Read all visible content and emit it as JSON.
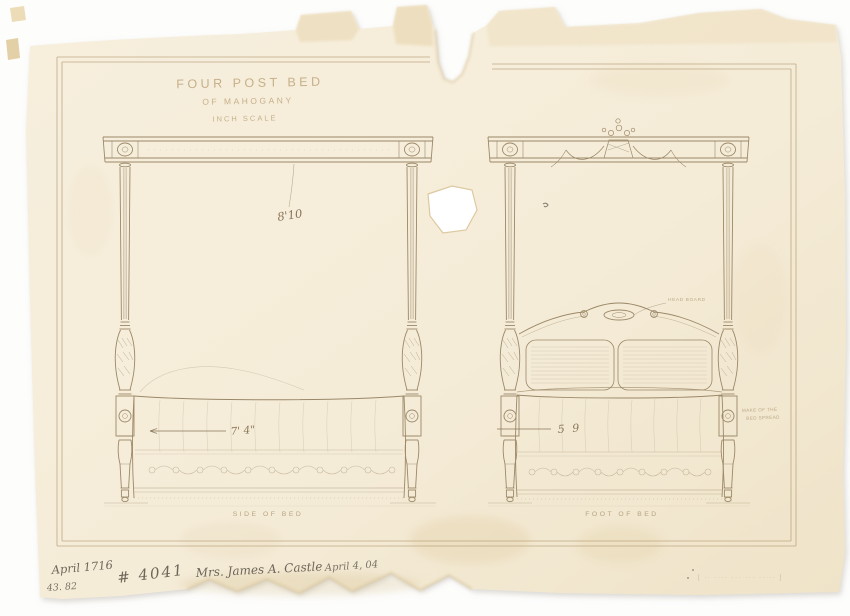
{
  "sheet": {
    "title": {
      "line1": "FOUR POST BED",
      "line2": "OF MAHOGANY",
      "line3": "INCH SCALE"
    },
    "colors": {
      "paper": "#f5ecd8",
      "ink": "#9b8868",
      "graphite": "#6f665a"
    },
    "side_view": {
      "caption": "SIDE OF BED",
      "height_dim": "8'10",
      "length_dim": "7' 4\""
    },
    "foot_view": {
      "caption": "FOOT OF BED",
      "width_dim": "5 9",
      "headboard_label": "HEAD BOARD",
      "spread_note_line1": "MAKE OF THE",
      "spread_note_line2": "BED SPREAD"
    },
    "inscriptions": {
      "date_left_line1": "April 1716",
      "date_left_line2": "43. 82",
      "order_number": "# 4041",
      "client": "Mrs. James A. Castle",
      "date_right": "April 4, 04",
      "faint_stamp": "[ ·· ···· ··· ··· ····· ]"
    }
  }
}
